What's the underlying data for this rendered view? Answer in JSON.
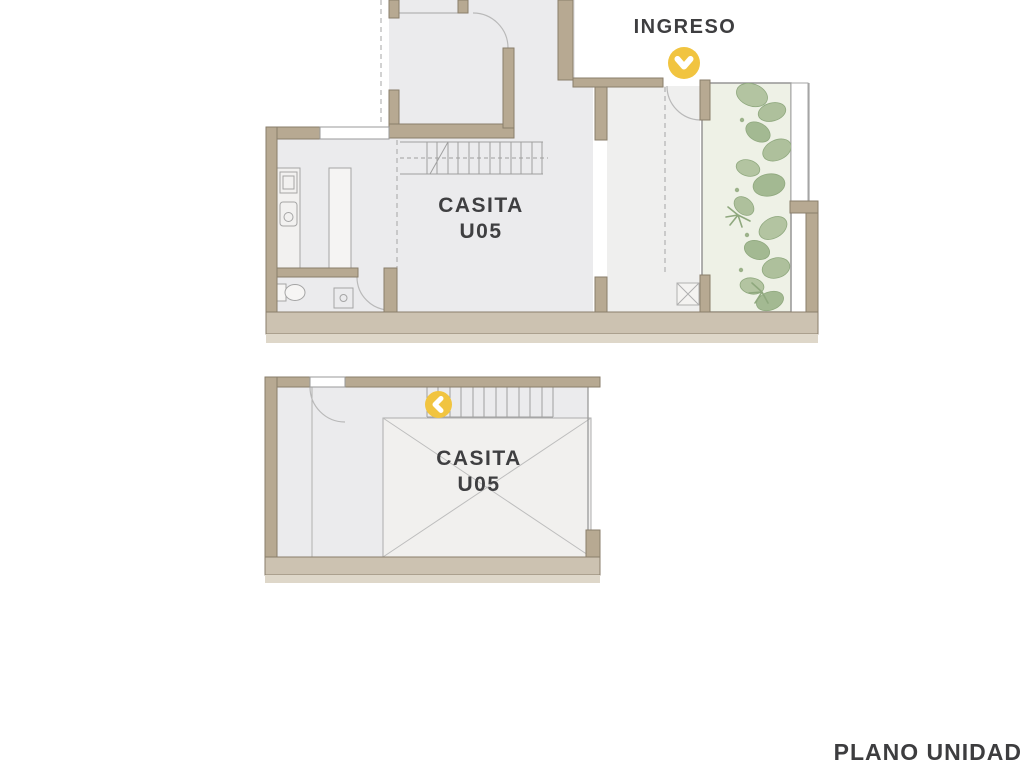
{
  "plan": {
    "entry_label": "INGRESO",
    "caption": "PLANO UNIDAD",
    "upper_unit": {
      "name_line1": "CASITA",
      "name_line2": "U05"
    },
    "lower_unit": {
      "name_line1": "CASITA",
      "name_line2": "U05"
    }
  },
  "markers": {
    "entry": {
      "icon": "chevron-down-icon",
      "color": "#F1C440"
    },
    "level_nav": {
      "icon": "chevron-left-icon",
      "color": "#F1C440"
    }
  },
  "colors": {
    "background": "#FFFFFF",
    "wall_fill": "#B7A992",
    "wall_outline": "#8A7E6B",
    "floor": "#EBEBED",
    "floor_light": "#F1F0EE",
    "plinth": "#CCC2B1",
    "plinth_light": "#DED7C9",
    "garden_floor": "#EEF1E6",
    "plant_green": "#A9BD97",
    "accent_yellow": "#F1C440",
    "label_text": "#3E3E40",
    "thin_line": "#A5A5A5"
  }
}
